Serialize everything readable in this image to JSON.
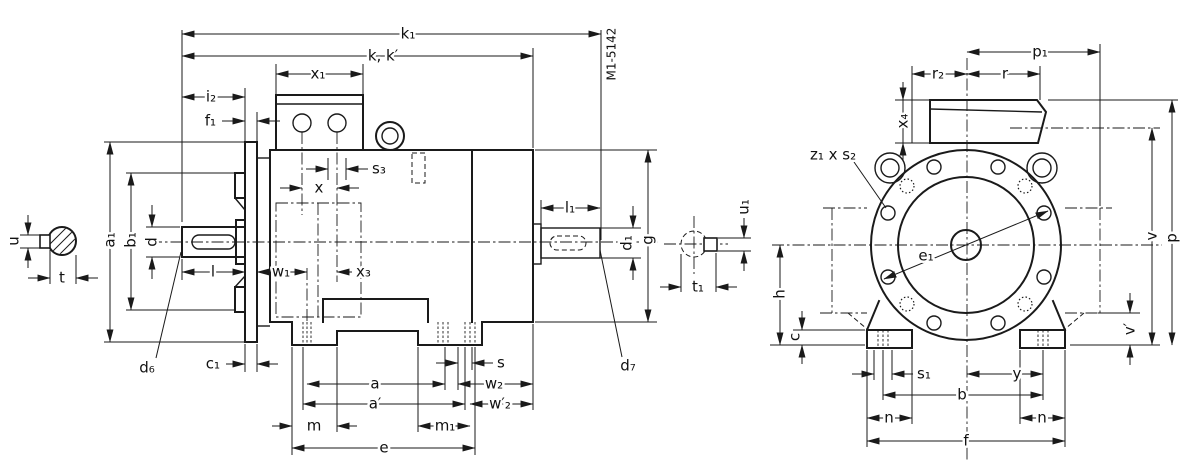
{
  "drawing": {
    "ink_color": "#1a1a1a",
    "background_color": "#ffffff",
    "drawing_no": "M1-5142"
  },
  "labels": {
    "k1": "k₁",
    "kk": "k, k′",
    "x1": "x₁",
    "i2": "i₂",
    "f1": "f₁",
    "s3": "s₃",
    "x": "x",
    "u": "u",
    "t": "t",
    "a1": "a₁",
    "b1": "b₁",
    "d": "d",
    "d6": "d₆",
    "c1": "c₁",
    "l": "l",
    "w1": "w₁",
    "x3": "x₃",
    "l1": "l₁",
    "d1": "d₁",
    "g": "g",
    "u1": "u₁",
    "t1": "t₁",
    "d7": "d₇",
    "s": "s",
    "a": "a",
    "a_prime": "a′",
    "m": "m",
    "m1": "m₁",
    "e": "e",
    "w2": "w₂",
    "w2_prime": "w′₂",
    "p1": "p₁",
    "r2": "r₂",
    "r": "r",
    "x4": "x₄",
    "z1s2": "z₁ x s₂",
    "e1": "e₁",
    "h": "h",
    "c": "c",
    "s1": "s₁",
    "y": "y",
    "b": "b",
    "n": "n",
    "f": "f",
    "v": "v",
    "v_prime": "v′",
    "p": "p"
  }
}
